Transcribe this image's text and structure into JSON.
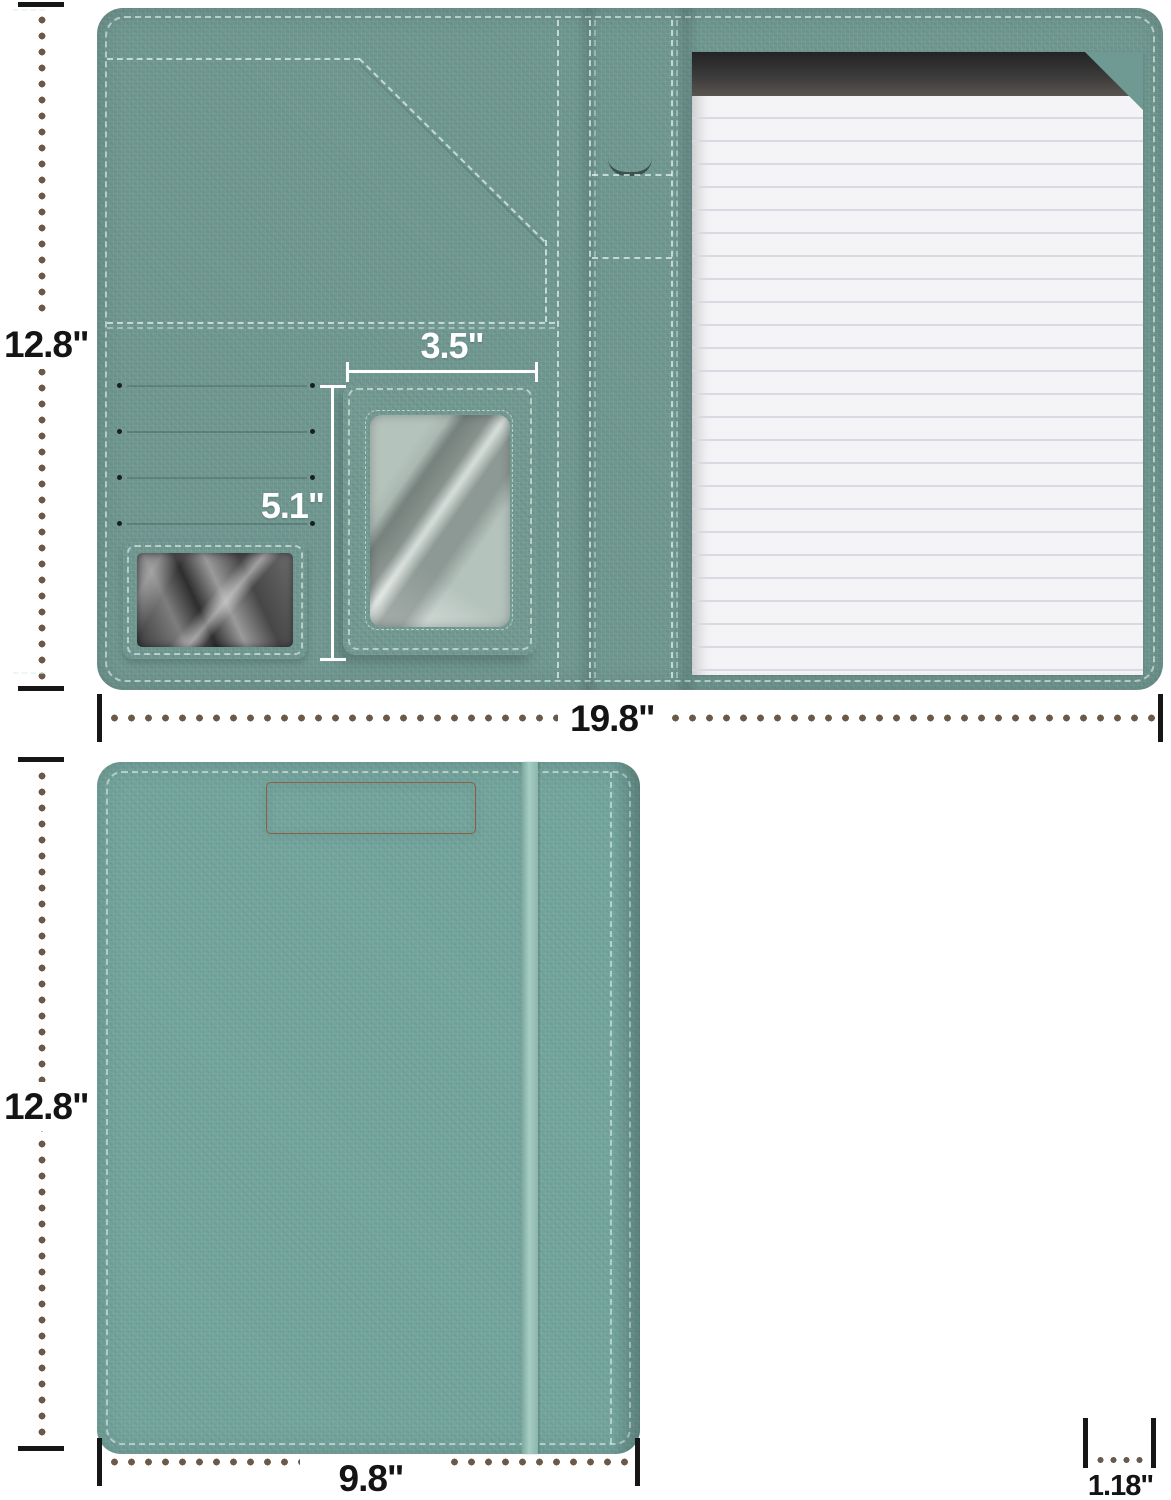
{
  "product_diagram": {
    "description": "portfolio clipboard folio dimension diagram",
    "open_view": {
      "height_label": "12.8\"",
      "width_label": "19.8\"",
      "id_window_width_label": "3.5\"",
      "id_window_height_label": "5.1\""
    },
    "front_view": {
      "height_label": "12.8\"",
      "width_label": "9.8\""
    },
    "side_view": {
      "thickness_label": "1.18\""
    },
    "colors": {
      "fabric_teal_cover": "#6f9a93",
      "fabric_teal_interior": "#6e968f",
      "fabric_teal_clipboard": "#72a39b",
      "elastic_band": "#93bfb6",
      "clip_rose_gold": "#e9bd95",
      "pad_binding_black": "#333335",
      "paper_white": "#f4f4f6",
      "paper_line": "#d7dbe1",
      "dimension_dot_brown": "#6b5949",
      "dimension_text_black": "#141414",
      "dimension_text_white": "#ffffff"
    }
  }
}
